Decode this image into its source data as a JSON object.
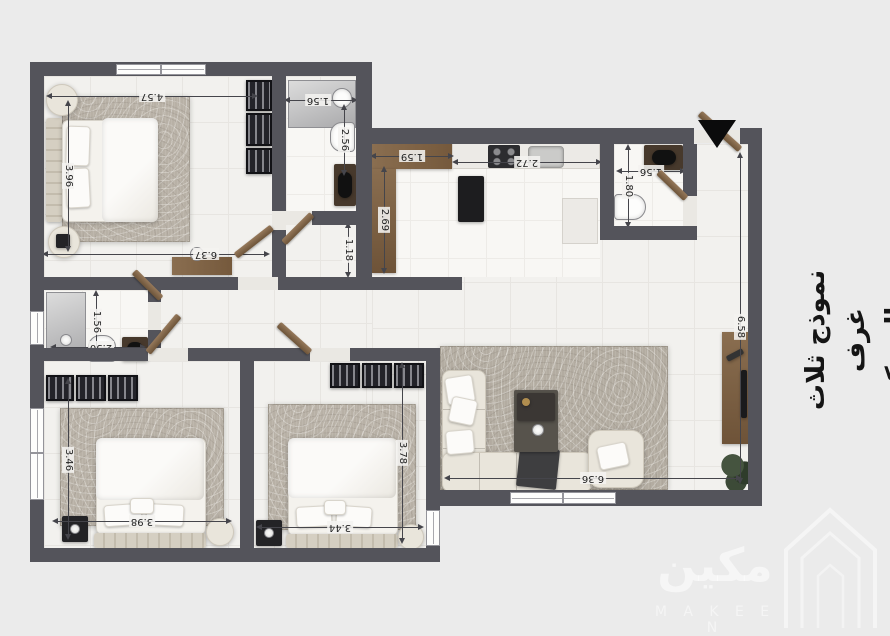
{
  "title": {
    "line1": "نموذج ثلاث غرف",
    "line2": "وصاله مكين 80"
  },
  "watermark": {
    "arabic": "مكين",
    "latin": "M A K E E N"
  },
  "dims": {
    "bedroom1_width": "4.57",
    "bedroom1_height": "3.96",
    "bedroom1_total": "6.37",
    "bath2_width": "1.56",
    "bath2_height": "2.56",
    "kitchen_counter_w": "1.59",
    "kitchen_counter_h": "2.69",
    "kitchen_width": "2.72",
    "hall_width": "1.18",
    "bath_right_width": "1.56",
    "bath_right_height": "1.80",
    "living_height": "6.58",
    "living_width": "6.36",
    "bath3_height": "1.56",
    "bath3_width": "2.50",
    "bedroom2_height": "3.46",
    "bedroom2_width": "3.98",
    "bedroom3_height": "3.78",
    "bedroom3_width": "3.44"
  },
  "colors": {
    "background": "#ebebeb",
    "wall": "#54545b",
    "floor_tile": "#f2f1ee",
    "floor_marble": "#f8f7f4",
    "wood": "#8a6e50",
    "rug": "#b8b1a6",
    "wardrobe": "#232329",
    "entry_marker": "#0b0b0c"
  }
}
